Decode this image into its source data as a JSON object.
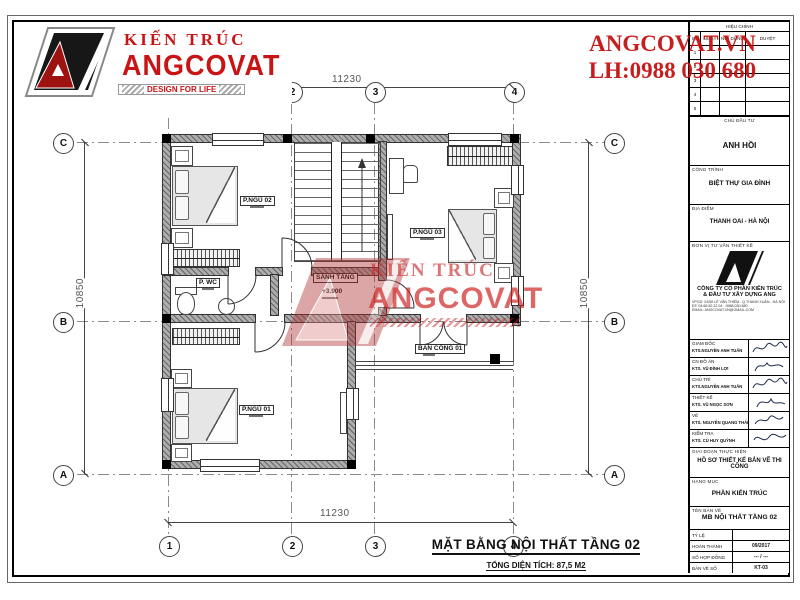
{
  "brand": {
    "name_top": "KIẾN TRÚC",
    "name_main": "ANGCOVAT",
    "tagline": "DESIGN FOR LIFE",
    "site": "ANGCOVAT.VN",
    "phone": "LH:0988 030 680"
  },
  "colors": {
    "accent_red": "#c81414",
    "wall_gray": "#adadad",
    "line": "#333333"
  },
  "plan": {
    "title": "MẶT BẰNG NỘI THẤT TẦNG 02",
    "subtitle": "TỔNG DIỆN TÍCH: 87,5 M2",
    "dim_width": "11230",
    "dim_height": "10850",
    "grid_cols": [
      "1",
      "2",
      "3",
      "4"
    ],
    "grid_rows": [
      "C",
      "B",
      "A"
    ],
    "rooms": {
      "bed2": "P.NGỦ 02",
      "bed3": "P.NGỦ 03",
      "bed1": "P.NGỦ 01",
      "wc": "P. WC",
      "hall": "SẢNH TẦNG",
      "hall_level": "+3.900",
      "balcony": "BAN CÔNG 01"
    }
  },
  "titleblock": {
    "revision": {
      "title": "HIỆU CHỈNH",
      "cols": [
        "SỐ",
        "NGÀY",
        "NỘI DUNG",
        "DUYỆT"
      ],
      "rows": [
        "1",
        "2",
        "3",
        "4",
        "5"
      ]
    },
    "investor_label": "CHỦ ĐẦU TƯ",
    "investor": "ANH HỒI",
    "project_label": "CÔNG TRÌNH",
    "project": "BIỆT THỰ GIA ĐÌNH",
    "location_label": "ĐỊA ĐIỂM",
    "location": "THANH OAI - HÀ NỘI",
    "consultant_label": "ĐƠN VỊ TƯ VẤN THIẾT KẾ",
    "company1": "CÔNG TY CỔ PHẦN KIẾN TRÚC",
    "company2": "& ĐẦU TƯ XÂY DỰNG  ANG",
    "contact1": "VPGD: 24/56 LÊ VĂN THIÊM - Q.THANH XUÂN - HÀ NỘI",
    "contact2": "ĐT: 04.66.82.22.04 - 0988.030.680",
    "contact3": "EMAIL: ANGCOVAT.VN@GMAIL.COM",
    "signatures": [
      {
        "role": "GIÁM ĐỐC",
        "name": "KTS.NGUYỄN ANH TUẤN"
      },
      {
        "role": "CN ĐỒ ÁN",
        "name": "KTS. VŨ ĐÌNH LỢI"
      },
      {
        "role": "CHỦ TRÌ",
        "name": "KTS.NGUYỄN ANH TUẤN"
      },
      {
        "role": "THIẾT KẾ",
        "name": "KTS. VŨ NGỌC SƠN"
      },
      {
        "role": "VẼ",
        "name": "KTS. NGUYỄN QUANG THÁI"
      },
      {
        "role": "KIỂM TRA",
        "name": "KTS. CÙ HUY QUỲNH"
      }
    ],
    "stage_label": "GIAI ĐOẠN THỰC HIỆN",
    "stage": "HỒ SƠ THIẾT KẾ BẢN VẼ THI CÔNG",
    "category_label": "HẠNG MỤC",
    "category": "PHẦN KIẾN TRÚC",
    "drawing_label": "TÊN BẢN VẼ",
    "drawing": "MB NỘI THẤT TẦNG 02",
    "meta": [
      {
        "label": "TỶ LỆ",
        "value": ""
      },
      {
        "label": "HOÀN THÀNH",
        "value": "09/2017"
      },
      {
        "label": "SỐ HỢP ĐỒNG",
        "value": "--- / ---"
      },
      {
        "label": "BẢN VẼ SỐ",
        "value": "KT-03"
      }
    ]
  }
}
